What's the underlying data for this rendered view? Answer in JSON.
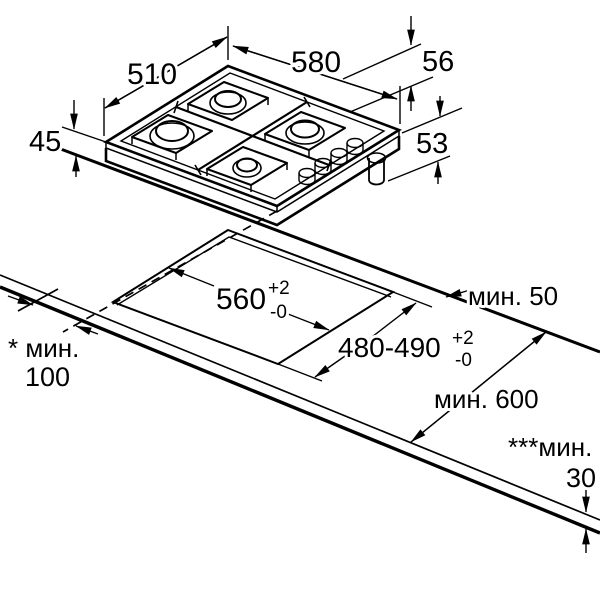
{
  "diagram": {
    "type": "appliance-installation-drawing",
    "subject": "4-burner built-in gas hob with worktop cutout",
    "units": "mm",
    "language": "ru",
    "colors": {
      "line": "#000000",
      "background": "#ffffff",
      "burner_cap": "#bdbdbd"
    },
    "hob_dimensions": {
      "depth": "510",
      "width": "580",
      "height_above_worktop": "56",
      "body_height": "45",
      "depth_below_incl_gas": "53"
    },
    "cutout_dimensions": {
      "width": "560",
      "width_tol_plus": "+2",
      "width_tol_minus": "-0",
      "depth": "480-490",
      "depth_tol_plus": "+2",
      "depth_tol_minus": "-0"
    },
    "clearances": {
      "rear_min": "мин. 50",
      "side_min_label": "* мин.",
      "side_min_value": "100",
      "worktop_depth_min": "мин. 600",
      "worktop_thickness_label": "***мин.",
      "worktop_thickness_value": "30"
    }
  }
}
